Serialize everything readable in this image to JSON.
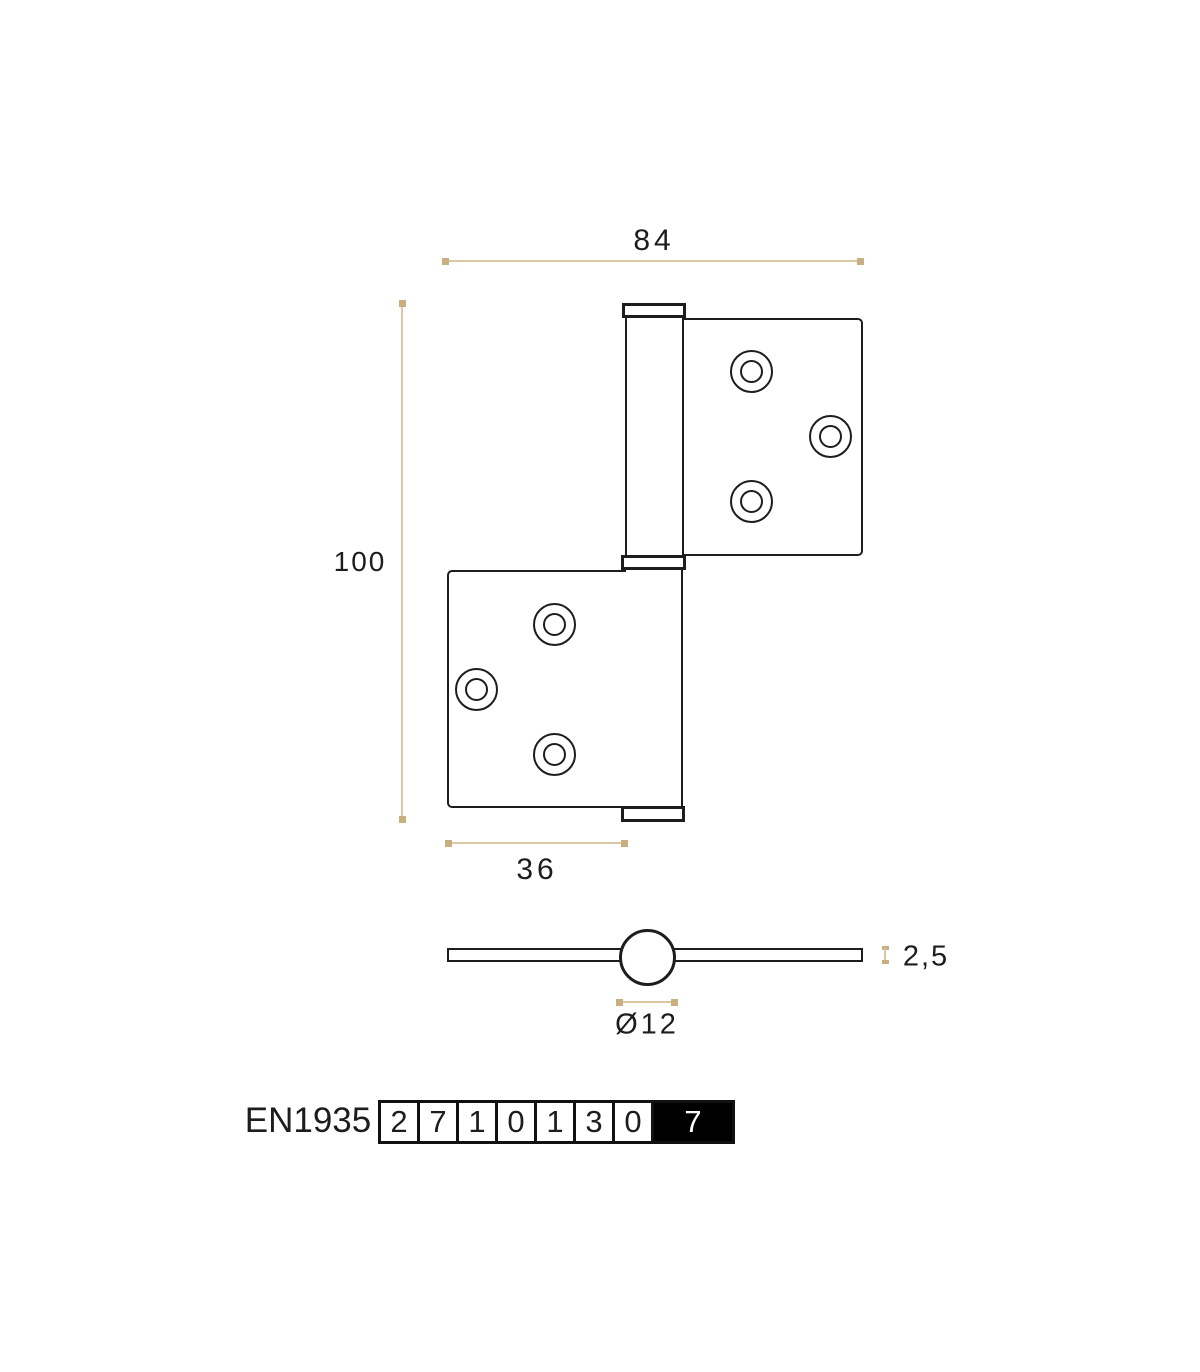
{
  "drawing": {
    "title": "flag hinge dimensioned drawing",
    "dims": {
      "overall_width": "84",
      "overall_height": "100",
      "leaf_width": "36",
      "leaf_thickness": "2,5",
      "knuckle_diameter": "Ø12"
    },
    "standard": {
      "name": "EN1935",
      "grades": [
        "2",
        "7",
        "1",
        "0",
        "1",
        "3",
        "0",
        "7"
      ]
    },
    "colors": {
      "outline": "#1d1d1b",
      "dimension_line": "#dbc8a2",
      "dimension_dot": "#c9ae7f",
      "grade_highlight_bg": "#000000",
      "grade_highlight_text": "#ffffff"
    }
  }
}
